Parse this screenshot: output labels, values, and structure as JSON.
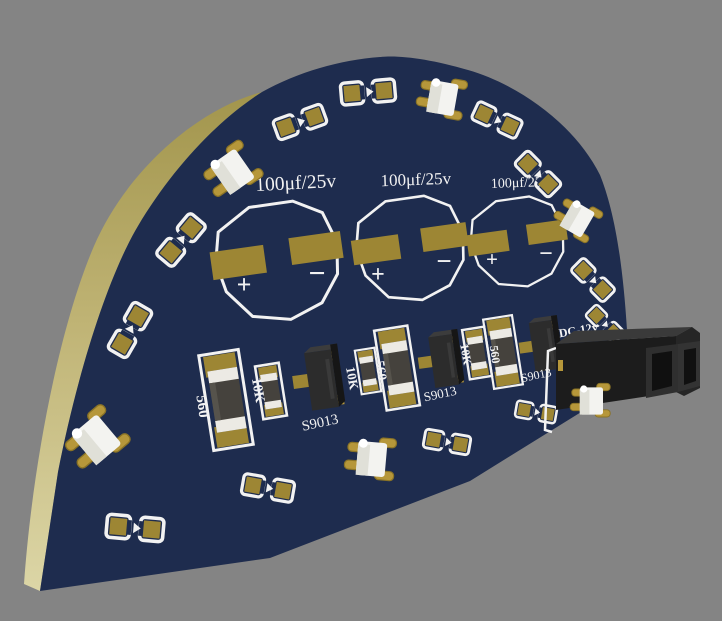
{
  "scene": {
    "description": "3D render of a semicircular dark-blue PCB viewed at an angle on a gray background",
    "background_color": "#848484"
  },
  "board": {
    "face_color": "#1e2c4e",
    "rim_color_top": "#a2954c",
    "rim_color_bottom": "#ddd7a8",
    "silkscreen_color": "#f2f2f2",
    "pad_color": "#9d8634",
    "component_gold": "#b6973a",
    "connector_color": "#1c1c1c"
  },
  "silkscreen": {
    "capacitors": [
      {
        "label": "100μf/25v"
      },
      {
        "label": "100μf/25v"
      },
      {
        "label": "100μf/25v"
      }
    ],
    "resistors_560": [
      "560",
      "560",
      "560"
    ],
    "resistors_10k": [
      "10K",
      "10K",
      "10K"
    ],
    "transistors": [
      "S9013",
      "S9013",
      "S9013"
    ],
    "power_label": "DC-12v",
    "polarity_plus": "+",
    "polarity_minus": "−"
  }
}
